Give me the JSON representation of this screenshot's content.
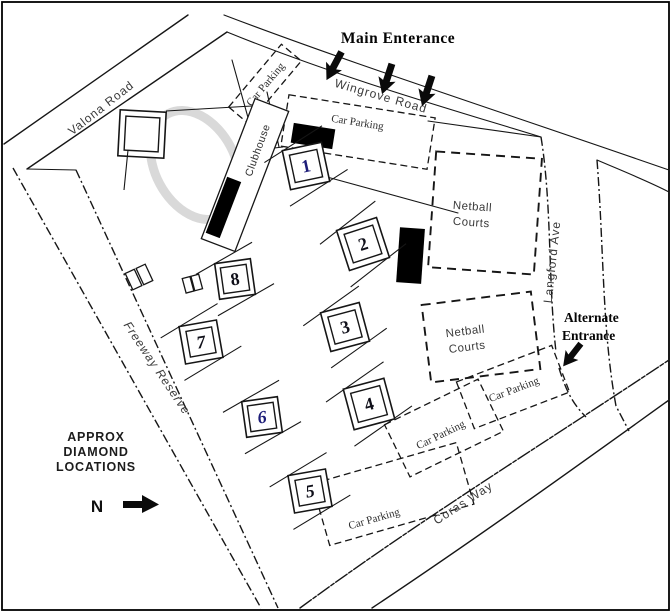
{
  "figure": {
    "type": "sports-reserve-site-map",
    "background": "#ffffff",
    "frame_color": "#000000"
  },
  "annotations": {
    "main_entrance": "Main Enterance",
    "alternate_entrance": {
      "line1": "Alternate",
      "line2": "Entrance"
    }
  },
  "roads": {
    "valona": "Valona Road",
    "wingrove": "Wingrove Road",
    "langford": "Langford Ave",
    "coras": "Coras Way",
    "freeway_reserve": "Freeway Reserve"
  },
  "facilities": {
    "car_parking": "Car Parking",
    "clubhouse": "Clubhouse",
    "netball": {
      "line1": "Netball",
      "line2": "Courts"
    }
  },
  "legend": {
    "line1": "APPROX",
    "line2": "DIAMOND",
    "line3": "LOCATIONS",
    "north_label": "N"
  },
  "icons": {
    "entrance_arrow": "down-left-solid-arrow",
    "north_arrow": "right-solid-arrow"
  },
  "diamonds": [
    {
      "label": "1",
      "color": "#1c1c78"
    },
    {
      "label": "2",
      "color": "#10101a"
    },
    {
      "label": "3",
      "color": "#10101a"
    },
    {
      "label": "4",
      "color": "#10101a"
    },
    {
      "label": "5",
      "color": "#10101a"
    },
    {
      "label": "6",
      "color": "#1c1c78"
    },
    {
      "label": "7",
      "color": "#10101a"
    },
    {
      "label": "8",
      "color": "#10101a"
    }
  ],
  "colors": {
    "ink": "#161616",
    "label_gray": "#3a3a3a",
    "oval_gray": "#d9d9d9",
    "diamond_navy": "#1c1c78"
  }
}
